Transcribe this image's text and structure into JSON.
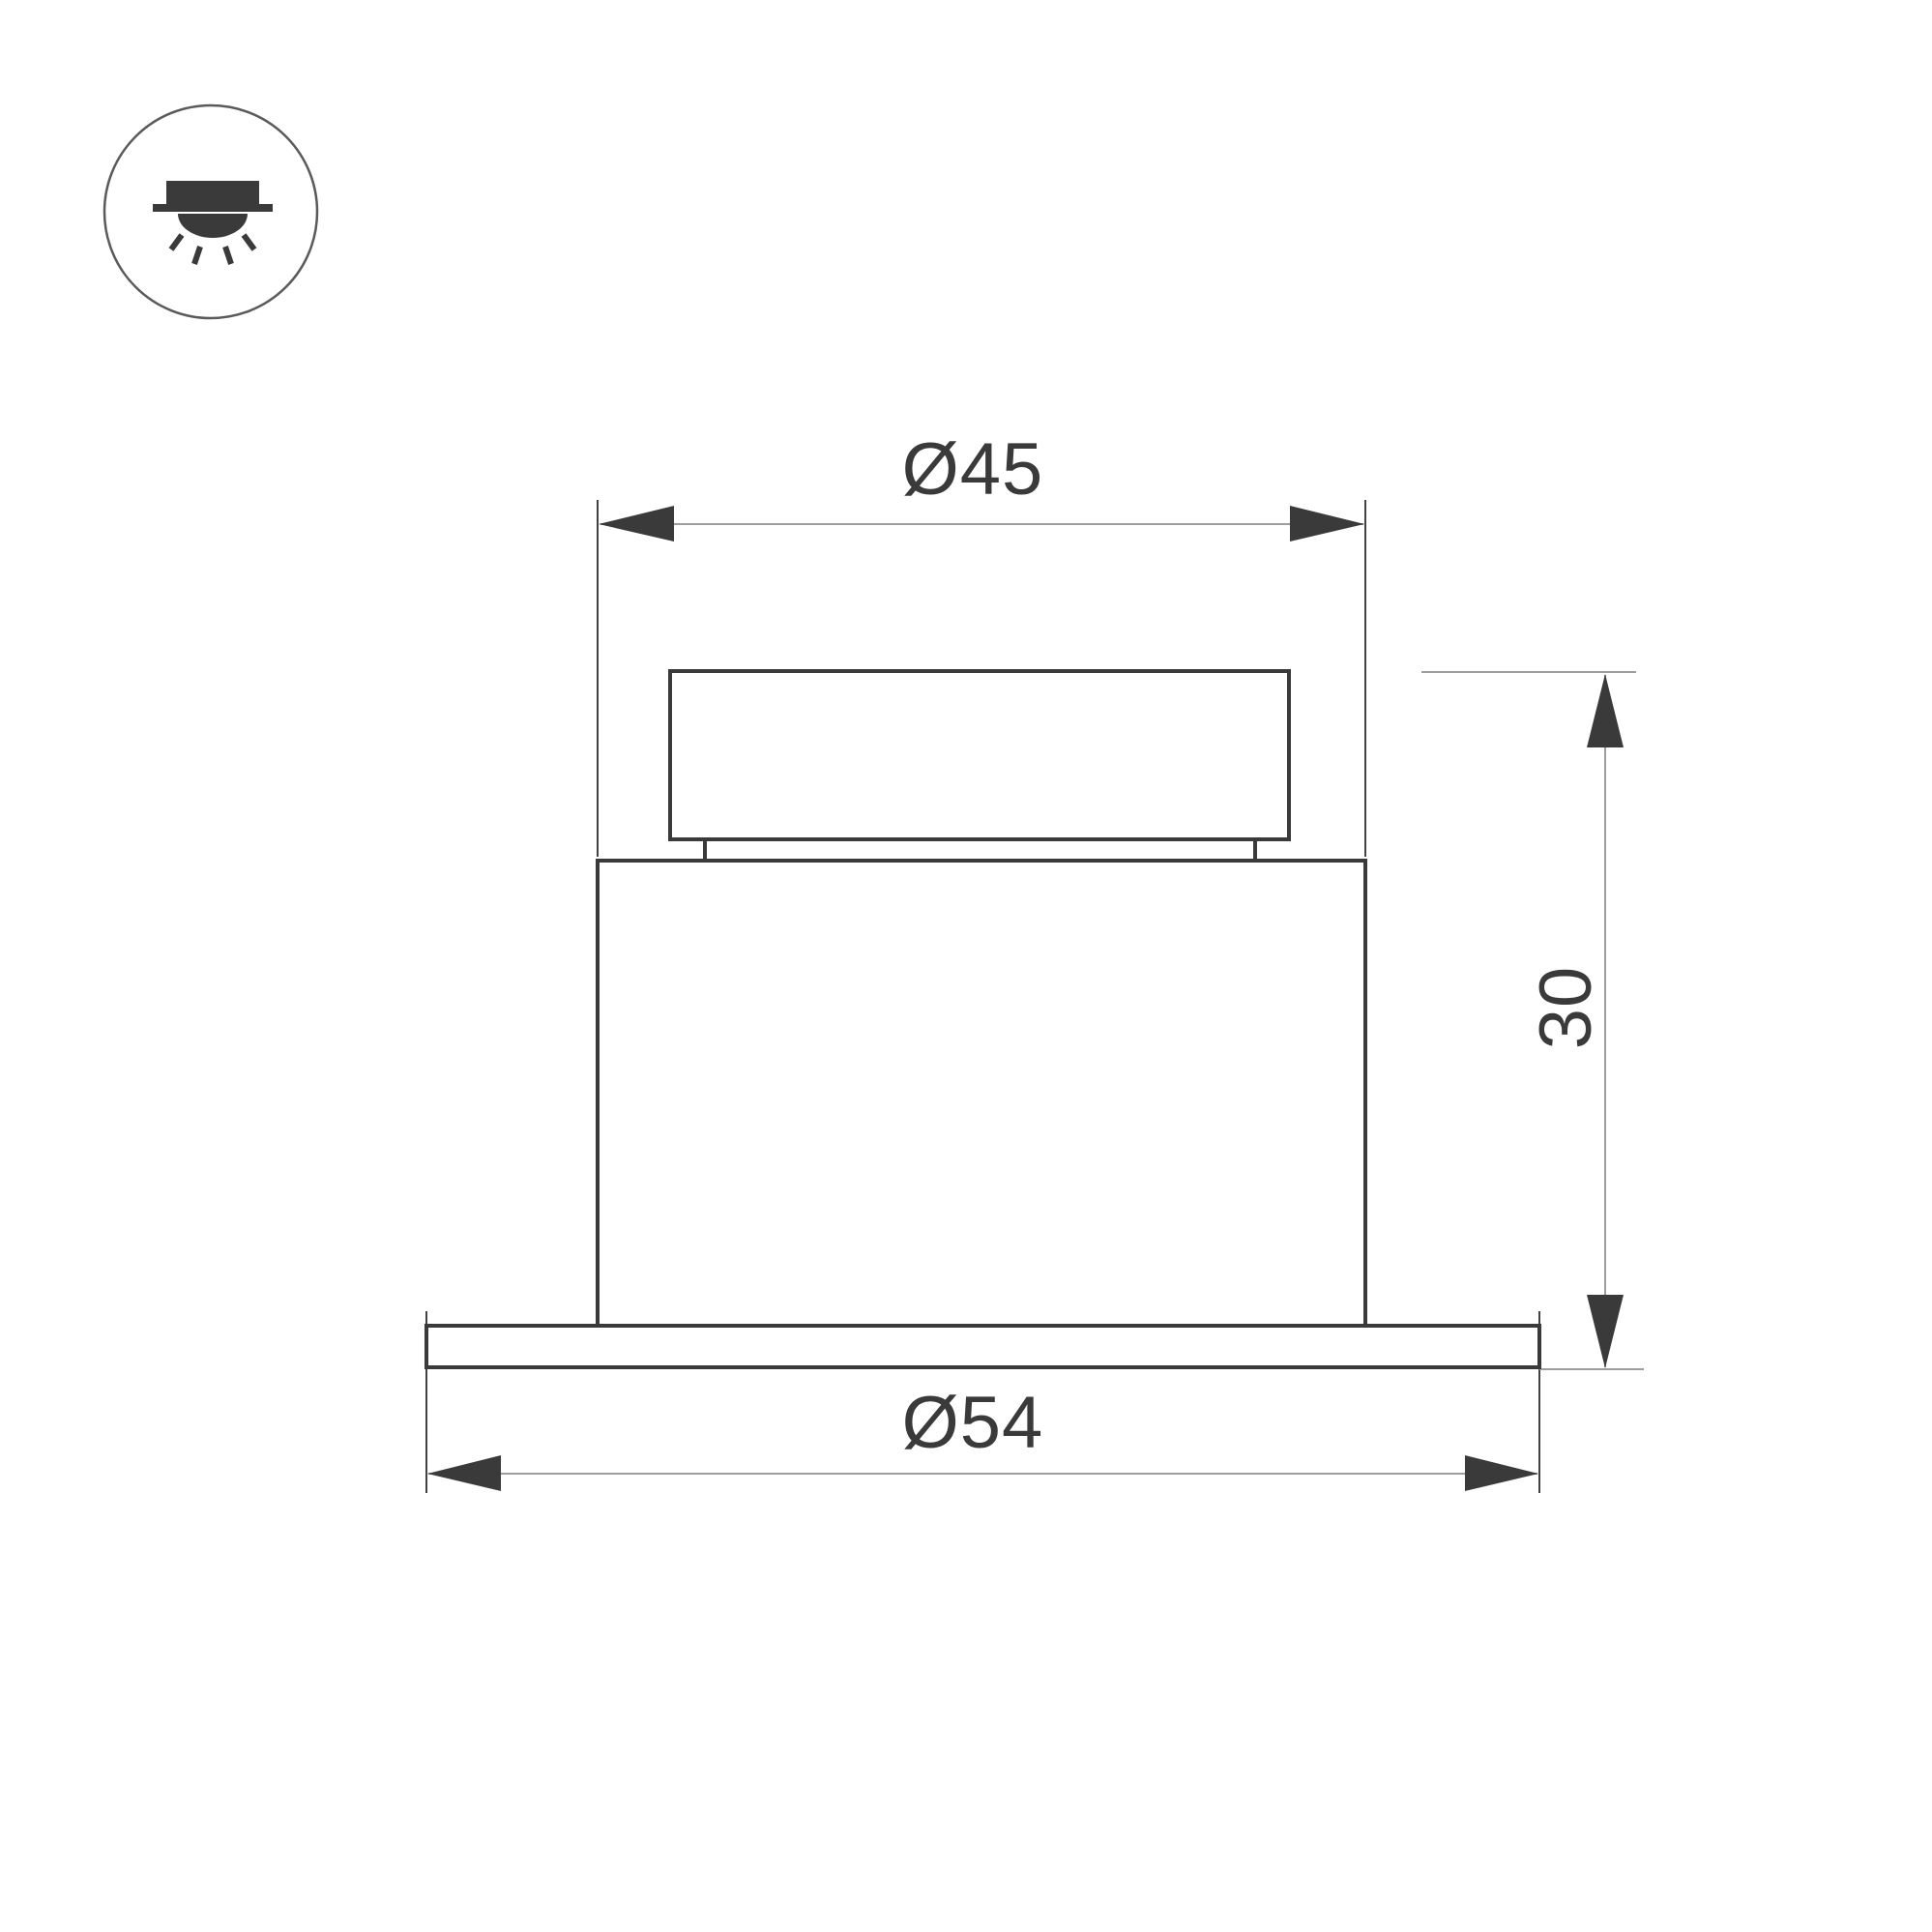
{
  "icon": {
    "name": "recessed-downlight-icon"
  },
  "dimensions": {
    "top_diameter": {
      "label": "Ø45"
    },
    "flange_diameter": {
      "label": "Ø54"
    },
    "height": {
      "label": "30"
    }
  },
  "colors": {
    "outline": "#3a3a3a",
    "ext_line": "#424242",
    "dim_line": "#9e9e9e",
    "icon_ring": "#5a5a5a",
    "background": "#ffffff"
  }
}
